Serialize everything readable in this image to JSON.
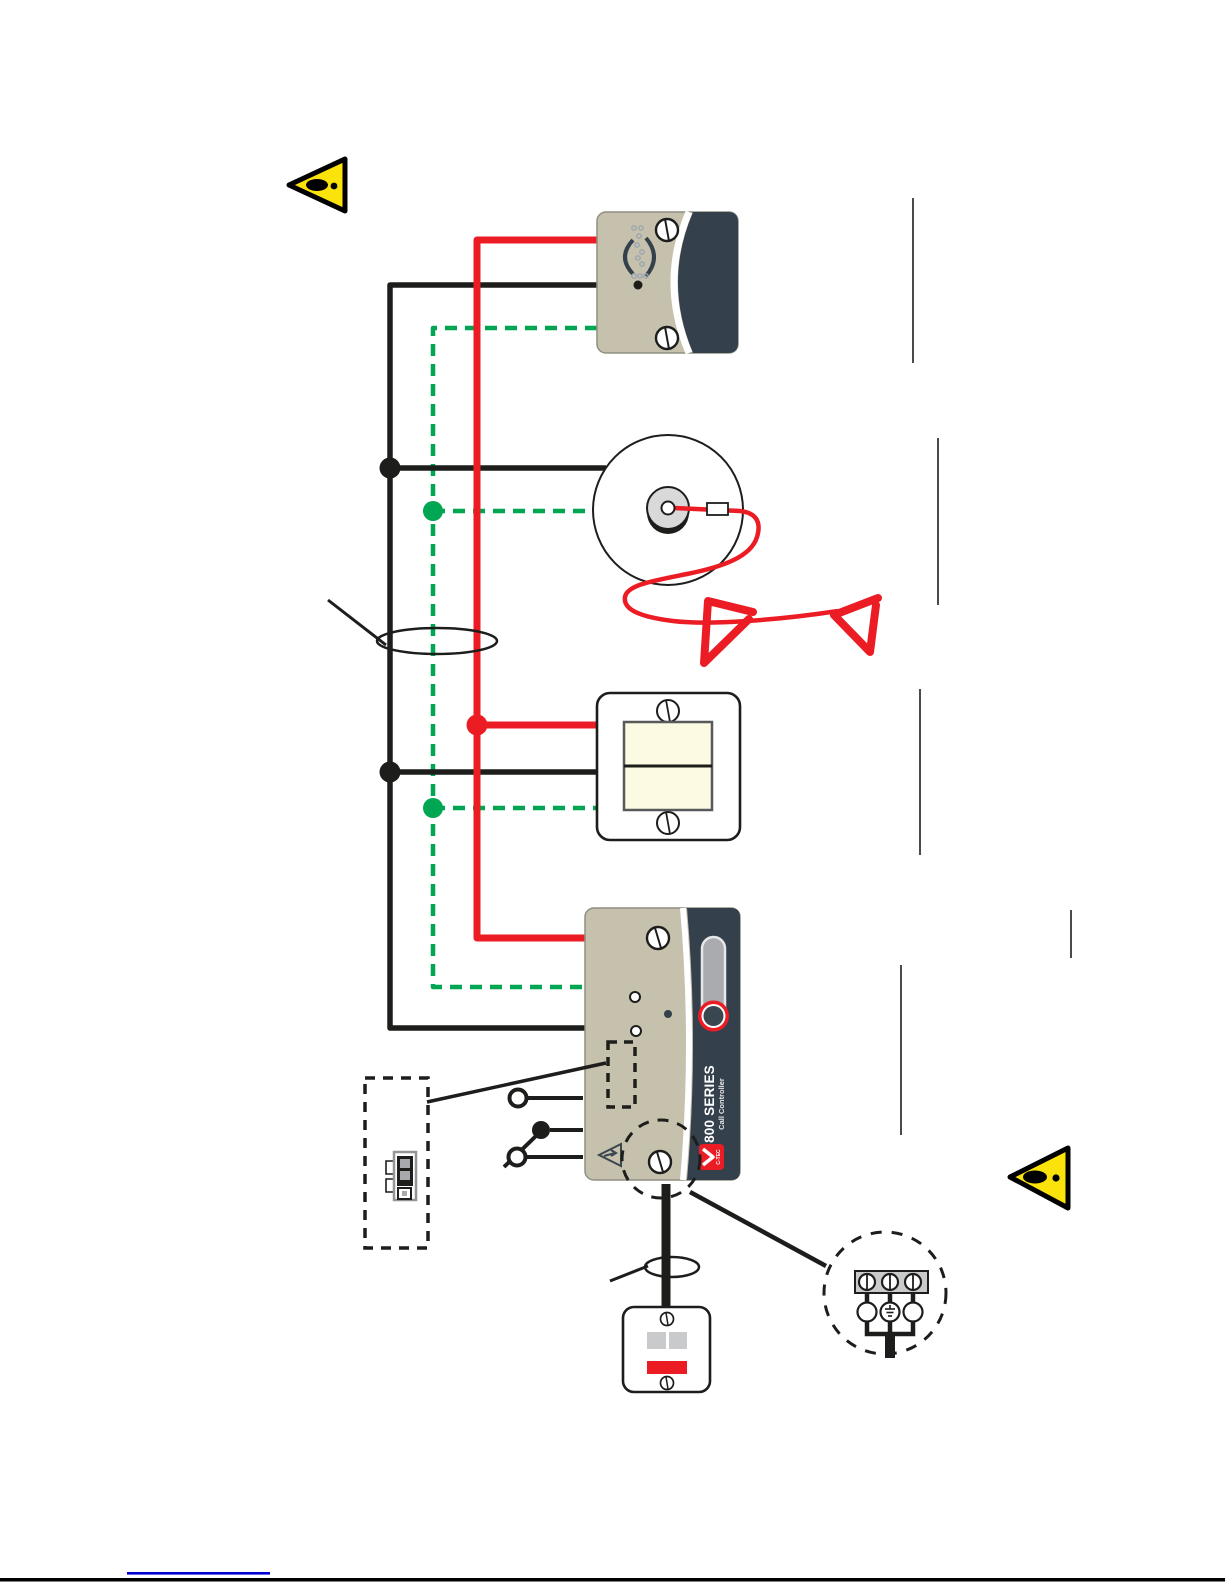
{
  "page": {
    "type": "installation-wiring-diagram",
    "orientation": "rotated-90-ccw",
    "background": "#ffffff",
    "width": 1225,
    "height": 1585
  },
  "palette": {
    "wire_black": "#1d1d1b",
    "wire_red": "#ec1c24",
    "wire_green": "#00a651",
    "device_beige": "#c6c1ac",
    "device_navy": "#34404c",
    "warning_yellow": "#fbe20b",
    "rocker_cream": "#fcfae3",
    "metal_gray": "#c9cacc",
    "slider_gray": "#a9abae",
    "link_blue": "#0000d4"
  },
  "controller": {
    "series_label": "800 SERIES",
    "model_label": "Call Controller",
    "brand": "C-TEC"
  },
  "wires": [
    {
      "name": "red-bus",
      "color": "#ec1c24",
      "style": "solid"
    },
    {
      "name": "black-bus",
      "color": "#1d1d1b",
      "style": "solid"
    },
    {
      "name": "green-bus",
      "color": "#00a651",
      "style": "dashed"
    }
  ],
  "devices": [
    {
      "name": "sounder-unit",
      "shape": "beige-navy-plate-with-speaker-symbol"
    },
    {
      "name": "ceiling-pull-cord-unit",
      "shape": "ceiling-rose-with-red-cord-and-two-pull-handles"
    },
    {
      "name": "reset-switch-plate",
      "shape": "white-plate-with-cream-rocker"
    },
    {
      "name": "call-controller",
      "shape": "beige-navy-plate-with-slider-and-red-ring-button"
    },
    {
      "name": "mains-switch-unit",
      "shape": "white-plate-with-two-gray-keys-and-red-bar"
    }
  ],
  "details": [
    {
      "name": "connector-detail-box",
      "shape": "dashed-rectangle-with-2way-connector"
    },
    {
      "name": "relay-contact-symbol",
      "shape": "changeover-contact"
    },
    {
      "name": "mains-terminal-detail",
      "shape": "dashed-circle-with-3-screw-terminals-and-earth"
    },
    {
      "name": "cable-marker-1",
      "shape": "ellipse-around-bus-wires"
    },
    {
      "name": "cable-marker-2",
      "shape": "ellipse-around-mains-cable"
    }
  ],
  "warnings": [
    {
      "name": "warning-triangle-top",
      "symbol": "exclamation"
    },
    {
      "name": "warning-triangle-bottom",
      "symbol": "exclamation"
    }
  ],
  "footer": {
    "link_underline_color": "#0000d4",
    "bottom_rule_color": "#000000"
  }
}
